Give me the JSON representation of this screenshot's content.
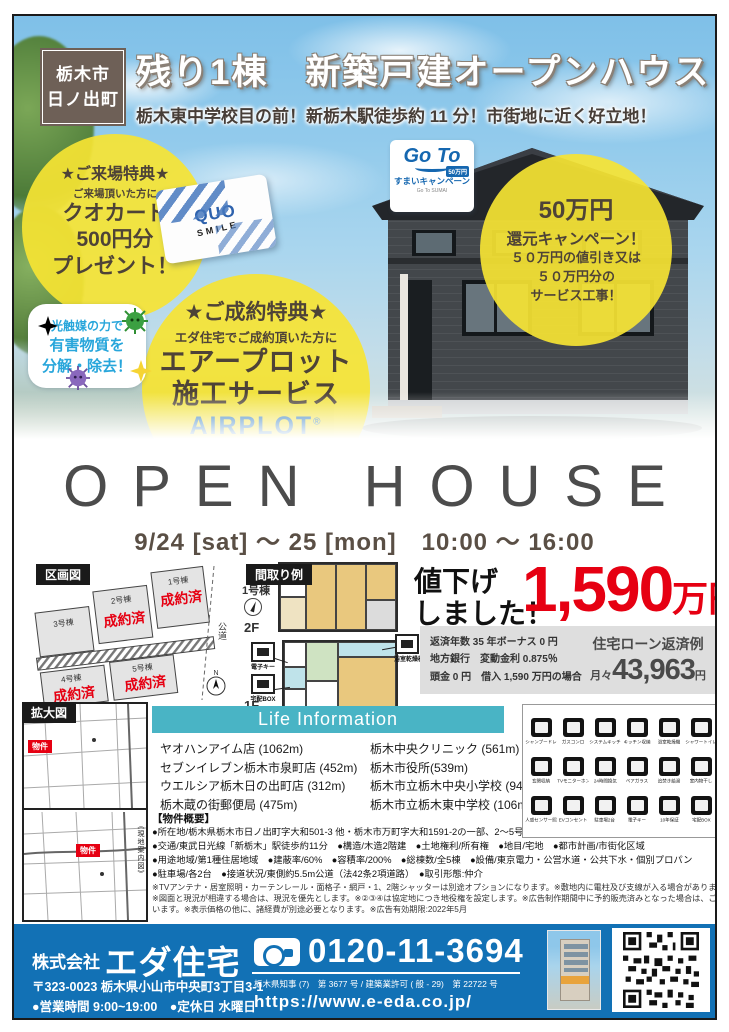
{
  "header": {
    "location": {
      "line1": "栃木市",
      "line2": "日ノ出町"
    },
    "title": "残り1棟　新築戸建オープンハウス",
    "subtitle": "栃木東中学校目の前！新栃木駅徒歩約 11 分！市街地に近く好立地！"
  },
  "offers": {
    "visitor": {
      "title": "★ご来場特典★",
      "lead": "ご来場頂いた方に",
      "line1": "クオカード",
      "line2": "500円分",
      "line3": "プレゼント！"
    },
    "quo_card": {
      "brand": "QUO",
      "sub": "SMILE"
    },
    "goto": {
      "logo": "Go To",
      "badge": "50万円",
      "label": "すまいキャンペーン",
      "sub": "Go To SUMAI"
    },
    "campaign": {
      "title": "50万円",
      "line1": "還元キャンペーン！",
      "line2": "５０万円の値引き又は",
      "line3": "５０万円分の",
      "line4": "サービス工事！"
    },
    "contract": {
      "title": "★ご成約特典★",
      "lead": "エダ住宅でご成約頂いた方に",
      "line1": "エアープロット",
      "line2": "施工サービス",
      "logo": "AIRPLOT",
      "reg": "®",
      "kana": "エアープロット"
    },
    "bubble": {
      "line1": "光触媒の力で",
      "line2": "有害物質を",
      "line3": "分解・除去！"
    }
  },
  "open_house": {
    "title": "OPEN HOUSE",
    "date": "9/24 [sat] ～ 25 [mon]　10:00 ～ 16:00"
  },
  "lot_map": {
    "label": "区画図",
    "road": "公道",
    "compass": "N",
    "lots": [
      {
        "name": "1号棟",
        "status": "成約済"
      },
      {
        "name": "2号棟",
        "status": "成約済"
      },
      {
        "name": "3号棟",
        "status": ""
      },
      {
        "name": "4号棟",
        "status": "成約済"
      },
      {
        "name": "5号棟",
        "status": "成約済"
      }
    ]
  },
  "floor_plan": {
    "label": "間取り例",
    "unit": "1号棟",
    "floor_upper": "2F",
    "floor_lower": "1F",
    "annotations": {
      "a1": "電子キー",
      "a2": "宅配BOX",
      "a3": "浴室乾燥機"
    }
  },
  "price": {
    "drop1": "値下げ",
    "drop2": "しました！",
    "amount": "1,590",
    "unit": "万円"
  },
  "loan": {
    "cond1": "返済年数 35 年ボーナス 0 円",
    "cond2": "地方銀行　変動金利 0.875％",
    "cond3": "頭金 0 円　借入 1,590 万円の場合",
    "title": "住宅ローン返済例",
    "monthly_prefix": "月々",
    "monthly": "43,963",
    "monthly_unit": "円"
  },
  "area_map": {
    "label": "拡大図",
    "marker": "物件",
    "side_label": "《現地案内図》"
  },
  "life_info": {
    "title": "Life Information",
    "left": [
      "ヤオハンアイム店 (1062m)",
      "セブンイレブン栃木市泉町店 (452m)",
      "ウエルシア栃木日の出町店 (312m)",
      "栃木蔵の街郵便局 (475m)"
    ],
    "right": [
      "栃木中央クリニック (561m)",
      "栃木市役所(539m)",
      "栃木市立栃木中央小学校 (949m)",
      "栃木市立栃木東中学校 (106m)"
    ]
  },
  "property": {
    "title": "【物件概要】",
    "bullets": [
      "●所在地/栃木県栃木市日ノ出町字大和501-3 他・栃木市万町字大和1591-2の一部、2～5号棟栃木県栃木市日ノ出町字大和1591-2の一部 他",
      "●交通/東武日光線「新栃木」駅徒歩約11分　●構造/木造2階建　●土地権利/所有権　●地目/宅地　●都市計画/市街化区域",
      "●用途地域/第1種住居地域　●建蔽率/60%　●容積率/200%　●総棟数/全5棟　●設備/東京電力・公営水道・公共下水・個別プロパン",
      "●駐車場/各2台　●接道状況/東側約5.5m公道（法42条2項道路）　●取引形態:仲介"
    ],
    "notes": [
      "※TVアンテナ・居室照明・カーテンレール・面格子・網戸・1、2階シャッターは別途オプションになります。※敷地内に電柱及び支線が入る場合があります。",
      "※図面と現況が相違する場合は、現況を優先とします。※②③④は協定地につき地役権を設定します。※広告制作期間中に予約販売済みとなった場合は、ご容赦願",
      "います。※表示価格の他に、諸経費が別途必要となります。※広告有効期限:2022年5月"
    ]
  },
  "equipment": {
    "items": [
      "シャンプードレッサー",
      "ガスコンロ",
      "システムキッチン",
      "キッチン収納",
      "浴室乾燥機",
      "シャワートイレ",
      "玄関収納",
      "TVモニターホン",
      "24時間換気",
      "ペアガラス",
      "追焚き給湯",
      "室内物干し",
      "人感センサー照明",
      "EVコンセント",
      "駐車場2台",
      "電子キー",
      "10年保証",
      "宅配BOX"
    ]
  },
  "footer": {
    "company_prefix": "株式会社",
    "company": "エダ住宅",
    "phone": "0120-11-3694",
    "address": "〒323-0023 栃木県小山市中央町3丁目3-1",
    "hours": "●営業時間 9:00~19:00　●定休日 水曜日",
    "license": "栃木県知事 (7)　第 3677 号 / 建築業許可 ( 般 - 29)　第 22722 号",
    "url": "https://www.e-eda.co.jp/"
  },
  "colors": {
    "accent_red": "#e60012",
    "footer_blue": "#1271b5",
    "banner_teal": "#49b4c5",
    "highlight_yellow": "#f6e433",
    "airplot_blue": "#1d6fb8"
  }
}
